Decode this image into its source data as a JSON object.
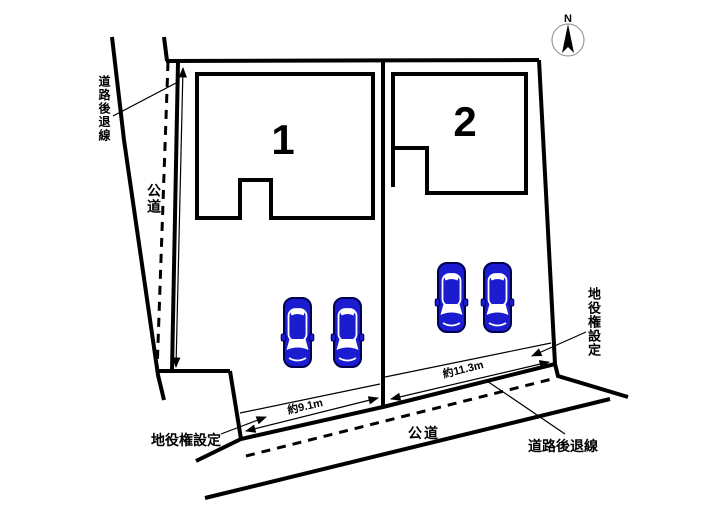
{
  "page": {
    "background": "#ffffff"
  },
  "compass": {
    "label": "N"
  },
  "lots": [
    {
      "number": "1",
      "frontage": "約9.1m",
      "car_count": 2
    },
    {
      "number": "2",
      "frontage": "約11.3m",
      "car_count": 2
    }
  ],
  "labels": {
    "setback_top_left": "道路後退線",
    "road_left": "公道",
    "easement_bottom_left": "地役権設定",
    "road_bottom": "公道",
    "setback_bottom_right": "道路後退線",
    "easement_right": "地役権設定"
  },
  "colors": {
    "line": "#000000",
    "car_body": "#1b1bd0",
    "car_outline": "#000050",
    "compass_circle": "#888888"
  }
}
